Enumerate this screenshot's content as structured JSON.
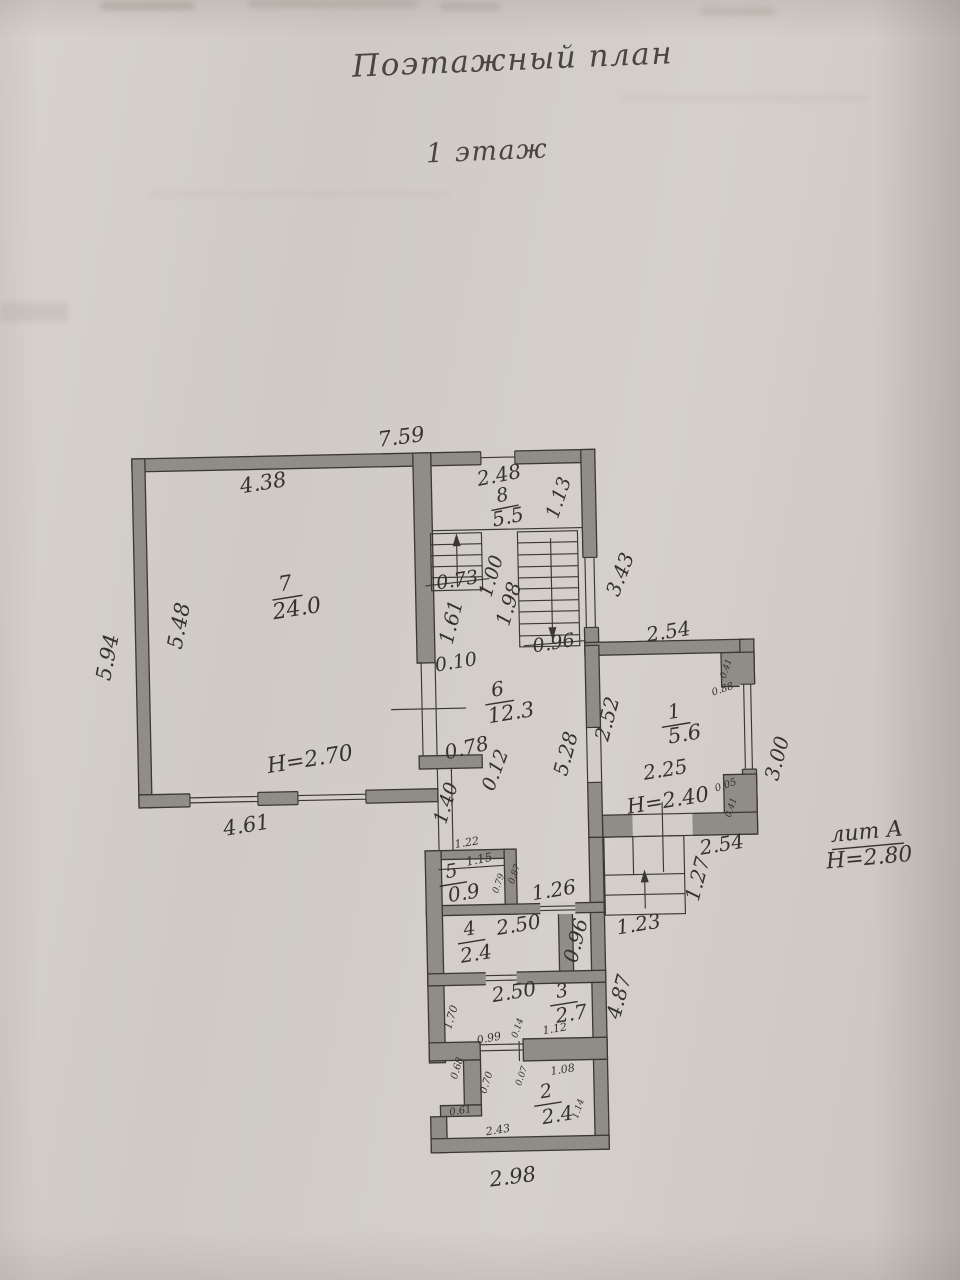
{
  "page": {
    "title": "Поэтажный план",
    "floor": "1 этаж"
  },
  "building": {
    "liter": "лит А",
    "floor_height": "H=2.80"
  },
  "rooms": [
    {
      "number": "1",
      "area": "5.6",
      "height": "H=2.40"
    },
    {
      "number": "2",
      "area": "2.4"
    },
    {
      "number": "3",
      "area": "2.7"
    },
    {
      "number": "4",
      "area": "2.4"
    },
    {
      "number": "5",
      "area": "0.9"
    },
    {
      "number": "6",
      "area": "12.3"
    },
    {
      "number": "7",
      "area": "24.0",
      "height": "H=2.70"
    },
    {
      "number": "8",
      "area": "5.5"
    }
  ],
  "colors": {
    "paper": "#d2cdc7",
    "wall": "#908c87",
    "line": "#3a3734",
    "ink": "#35322e"
  },
  "plan": {
    "labels": [
      {
        "t": "7.59",
        "x": 409,
        "y": 437,
        "s": 21,
        "r": -6,
        "n": "dim-top-outer"
      },
      {
        "t": "4.38",
        "x": 270,
        "y": 480,
        "s": 21,
        "r": -8,
        "n": "dim-room7-top"
      },
      {
        "t": "5.94",
        "x": 112,
        "y": 650,
        "s": 21,
        "r": -78,
        "n": "dim-left-outer"
      },
      {
        "t": "5.48",
        "x": 184,
        "y": 620,
        "s": 21,
        "r": -78,
        "n": "dim-room7-left"
      },
      {
        "t": "7",
        "x": 290,
        "y": 581,
        "s": 21,
        "r": -8,
        "u": 1,
        "n": "room7-number"
      },
      {
        "t": "24.0",
        "x": 301,
        "y": 606,
        "s": 22,
        "r": -8,
        "n": "room7-area"
      },
      {
        "t": "H=2.70",
        "x": 311,
        "y": 757,
        "s": 22,
        "r": -8,
        "n": "room7-height"
      },
      {
        "t": "4.61",
        "x": 246,
        "y": 822,
        "s": 21,
        "r": -8,
        "n": "dim-room7-bottom"
      },
      {
        "t": "2.48",
        "x": 506,
        "y": 477,
        "s": 20,
        "r": -10,
        "n": "dim-room8-top"
      },
      {
        "t": "8",
        "x": 509,
        "y": 497,
        "s": 19,
        "r": -10,
        "u": 1,
        "n": "room8-number"
      },
      {
        "t": "5.5",
        "x": 514,
        "y": 519,
        "s": 20,
        "r": -10,
        "n": "room8-area"
      },
      {
        "t": "1.13",
        "x": 566,
        "y": 500,
        "s": 19,
        "r": -70,
        "n": "dim-room8-right"
      },
      {
        "t": "3.43",
        "x": 626,
        "y": 578,
        "s": 20,
        "r": -68,
        "n": "dim-right-upper"
      },
      {
        "t": "0.73",
        "x": 462,
        "y": 581,
        "s": 19,
        "r": -8,
        "n": "dim-stair-small"
      },
      {
        "t": "1.00",
        "x": 497,
        "y": 577,
        "s": 19,
        "r": -72,
        "n": "dim-stair-1"
      },
      {
        "t": "1.98",
        "x": 514,
        "y": 605,
        "s": 20,
        "r": -72,
        "n": "dim-stair-2"
      },
      {
        "t": "1.61",
        "x": 456,
        "y": 622,
        "s": 20,
        "r": -75,
        "n": "dim-stair-3"
      },
      {
        "t": "0.96",
        "x": 557,
        "y": 646,
        "s": 19,
        "r": -8,
        "n": "dim-stair-big"
      },
      {
        "t": "0.10",
        "x": 459,
        "y": 663,
        "s": 19,
        "r": -8,
        "n": "dim-wall-step"
      },
      {
        "t": "2.54",
        "x": 672,
        "y": 637,
        "s": 20,
        "r": -8,
        "n": "dim-room1-top"
      },
      {
        "t": "6",
        "x": 500,
        "y": 691,
        "s": 20,
        "r": -8,
        "u": 1,
        "n": "room6-number"
      },
      {
        "t": "12.3",
        "x": 513,
        "y": 715,
        "s": 21,
        "r": -8,
        "n": "room6-area"
      },
      {
        "t": "2.52",
        "x": 610,
        "y": 722,
        "s": 20,
        "r": -74,
        "n": "dim-room1-left"
      },
      {
        "t": "5.28",
        "x": 568,
        "y": 756,
        "s": 20,
        "r": -74,
        "n": "dim-room6-right"
      },
      {
        "t": "0.78",
        "x": 468,
        "y": 749,
        "s": 20,
        "r": -12,
        "n": "dim-stub-length"
      },
      {
        "t": "0.12",
        "x": 497,
        "y": 771,
        "s": 19,
        "r": -68,
        "n": "dim-stub-width"
      },
      {
        "t": "1.40",
        "x": 447,
        "y": 803,
        "s": 19,
        "r": -72,
        "n": "dim-partition"
      },
      {
        "t": "1",
        "x": 676,
        "y": 717,
        "s": 20,
        "r": -8,
        "u": 1,
        "n": "room1-number"
      },
      {
        "t": "5.6",
        "x": 686,
        "y": 740,
        "s": 21,
        "r": -8,
        "n": "room1-area"
      },
      {
        "t": "2.25",
        "x": 666,
        "y": 775,
        "s": 20,
        "r": -8,
        "n": "dim-room1-width"
      },
      {
        "t": "H=2.40",
        "x": 668,
        "y": 806,
        "s": 21,
        "r": -8,
        "n": "room1-height"
      },
      {
        "t": "0.88",
        "x": 725,
        "y": 695,
        "s": 10,
        "r": -18,
        "n": "dim-pier-1"
      },
      {
        "t": "0.41",
        "x": 729,
        "y": 674,
        "s": 9,
        "r": -70,
        "n": "dim-pier-2"
      },
      {
        "t": "0.05",
        "x": 726,
        "y": 791,
        "s": 10,
        "r": -18,
        "n": "dim-pier-3"
      },
      {
        "t": "0.41",
        "x": 731,
        "y": 813,
        "s": 9,
        "r": -70,
        "n": "dim-pier-4"
      },
      {
        "t": "3.00",
        "x": 779,
        "y": 765,
        "s": 20,
        "r": -74,
        "n": "dim-room1-right"
      },
      {
        "t": "лит А",
        "x": 866,
        "y": 841,
        "s": 22,
        "r": -4,
        "u": 1,
        "n": "liter-label"
      },
      {
        "t": "H=2.80",
        "x": 868,
        "y": 867,
        "s": 22,
        "r": -4,
        "n": "building-height"
      },
      {
        "t": "2.54",
        "x": 721,
        "y": 851,
        "s": 20,
        "r": -8,
        "n": "dim-room1-bottom"
      },
      {
        "t": "1.27",
        "x": 697,
        "y": 884,
        "s": 20,
        "r": -74,
        "n": "dim-porch-depth"
      },
      {
        "t": "1.23",
        "x": 636,
        "y": 929,
        "s": 20,
        "r": -8,
        "n": "dim-porch-width"
      },
      {
        "t": "4.87",
        "x": 616,
        "y": 1000,
        "s": 20,
        "r": -74,
        "n": "dim-right-lower"
      },
      {
        "t": "1.22",
        "x": 466,
        "y": 843,
        "s": 11,
        "r": -8,
        "n": "dim-room5-outer"
      },
      {
        "t": "5",
        "x": 450,
        "y": 872,
        "s": 19,
        "r": -8,
        "u": 1,
        "n": "room5-number"
      },
      {
        "t": "0.9",
        "x": 462,
        "y": 894,
        "s": 20,
        "r": -8,
        "n": "room5-area"
      },
      {
        "t": "1.15",
        "x": 478,
        "y": 860,
        "s": 12,
        "r": -10,
        "n": "dim-room5-inner"
      },
      {
        "t": "0.79",
        "x": 497,
        "y": 884,
        "s": 9,
        "r": -70,
        "n": "dim-room5-h"
      },
      {
        "t": "0.87",
        "x": 513,
        "y": 875,
        "s": 9,
        "r": -70,
        "n": "dim-room5-w"
      },
      {
        "t": "1.26",
        "x": 552,
        "y": 893,
        "s": 20,
        "r": -8,
        "n": "dim-passage"
      },
      {
        "t": "2.50",
        "x": 516,
        "y": 927,
        "s": 20,
        "r": -8,
        "n": "dim-room4-top"
      },
      {
        "t": "4",
        "x": 467,
        "y": 930,
        "s": 19,
        "r": -8,
        "u": 1,
        "n": "room4-number"
      },
      {
        "t": "2.4",
        "x": 473,
        "y": 955,
        "s": 20,
        "r": -8,
        "n": "room4-area"
      },
      {
        "t": "0.96",
        "x": 574,
        "y": 943,
        "s": 20,
        "r": -74,
        "n": "dim-strip"
      },
      {
        "t": "2.50",
        "x": 510,
        "y": 994,
        "s": 20,
        "r": -8,
        "n": "dim-room3-top"
      },
      {
        "t": "3",
        "x": 558,
        "y": 994,
        "s": 19,
        "r": -8,
        "u": 1,
        "n": "room3-number"
      },
      {
        "t": "2.7",
        "x": 567,
        "y": 1017,
        "s": 20,
        "r": -8,
        "n": "room3-area"
      },
      {
        "t": "1.12",
        "x": 550,
        "y": 1031,
        "s": 11,
        "r": -8,
        "n": "dim-room3-b"
      },
      {
        "t": "1.70",
        "x": 447,
        "y": 1017,
        "s": 11,
        "r": -72,
        "n": "dim-room3-left"
      },
      {
        "t": "0.99",
        "x": 484,
        "y": 1039,
        "s": 11,
        "r": -10,
        "n": "dim-notch-1"
      },
      {
        "t": "0.14",
        "x": 513,
        "y": 1029,
        "s": 9,
        "r": -70,
        "n": "dim-notch-2"
      },
      {
        "t": "0.68",
        "x": 452,
        "y": 1068,
        "s": 10,
        "r": -72,
        "n": "dim-notch-3"
      },
      {
        "t": "0.70",
        "x": 481,
        "y": 1083,
        "s": 10,
        "r": -72,
        "n": "dim-notch-4"
      },
      {
        "t": "0.07",
        "x": 516,
        "y": 1077,
        "s": 9,
        "r": -70,
        "n": "dim-notch-5"
      },
      {
        "t": "0.61",
        "x": 454,
        "y": 1111,
        "s": 10,
        "r": -8,
        "n": "dim-notch-6"
      },
      {
        "t": "1.08",
        "x": 557,
        "y": 1072,
        "s": 11,
        "r": -8,
        "n": "dim-room2-top"
      },
      {
        "t": "2",
        "x": 540,
        "y": 1094,
        "s": 19,
        "r": -8,
        "u": 1,
        "n": "room2-number"
      },
      {
        "t": "2.4",
        "x": 551,
        "y": 1118,
        "s": 20,
        "r": -8,
        "n": "room2-area"
      },
      {
        "t": "1.14",
        "x": 572,
        "y": 1111,
        "s": 9,
        "r": -70,
        "n": "dim-room2-right"
      },
      {
        "t": "2.43",
        "x": 491,
        "y": 1131,
        "s": 11,
        "r": -8,
        "n": "dim-room2-bottom"
      },
      {
        "t": "2.98",
        "x": 505,
        "y": 1179,
        "s": 21,
        "r": -6,
        "n": "dim-bottom-outer"
      }
    ]
  }
}
